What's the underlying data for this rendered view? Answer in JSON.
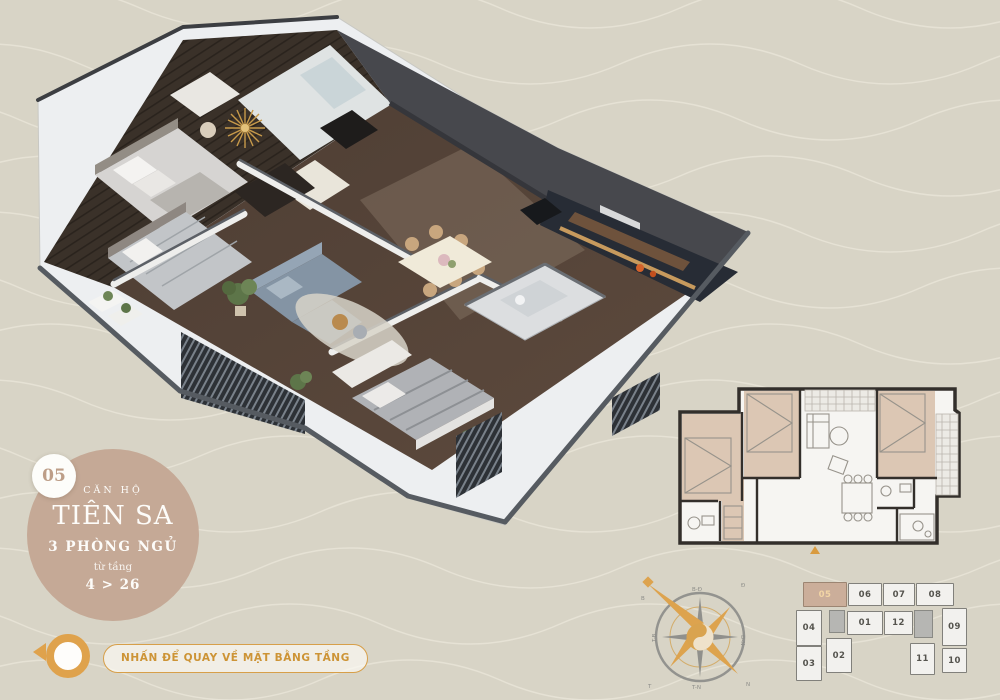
{
  "badge": {
    "unit_number": "05",
    "label_type": "CĂN HỘ",
    "name": "TIÊN SA",
    "bedrooms": "3 PHÒNG NGỦ",
    "floors_label": "từ tầng",
    "floors_range": "4 > 26",
    "circle_color": "#c5a996"
  },
  "back_button": {
    "label": "NHẤN ĐỂ QUAY VỀ MẶT BẰNG TẦNG",
    "accent_color": "#dfa24c"
  },
  "compass": {
    "corners": {
      "ne": "Đ",
      "se": "N",
      "sw": "T",
      "nw": "B"
    },
    "edges": {
      "top": "B-Đ",
      "right": "Đ-N",
      "bottom": "T-N",
      "left": "T-B"
    }
  },
  "floor_plate": {
    "highlighted_unit": "05",
    "units": [
      {
        "label": "05",
        "x": 13,
        "y": 4,
        "w": 44,
        "h": 25,
        "highlight": true
      },
      {
        "label": "06",
        "x": 58,
        "y": 5,
        "w": 34,
        "h": 23,
        "highlight": false
      },
      {
        "label": "07",
        "x": 93,
        "y": 5,
        "w": 32,
        "h": 23,
        "highlight": false
      },
      {
        "label": "08",
        "x": 126,
        "y": 5,
        "w": 38,
        "h": 23,
        "highlight": false
      },
      {
        "label": "04",
        "x": 6,
        "y": 32,
        "w": 26,
        "h": 36,
        "highlight": false
      },
      {
        "label": "01",
        "x": 57,
        "y": 33,
        "w": 36,
        "h": 24,
        "highlight": false
      },
      {
        "label": "12",
        "x": 94,
        "y": 33,
        "w": 29,
        "h": 24,
        "highlight": false
      },
      {
        "label": "09",
        "x": 152,
        "y": 30,
        "w": 25,
        "h": 38,
        "highlight": false
      },
      {
        "label": "03",
        "x": 6,
        "y": 68,
        "w": 26,
        "h": 35,
        "highlight": false
      },
      {
        "label": "02",
        "x": 36,
        "y": 60,
        "w": 26,
        "h": 35,
        "highlight": false
      },
      {
        "label": "11",
        "x": 120,
        "y": 65,
        "w": 25,
        "h": 32,
        "highlight": false
      },
      {
        "label": "10",
        "x": 152,
        "y": 70,
        "w": 25,
        "h": 25,
        "highlight": false
      }
    ],
    "cores": [
      {
        "x": 39,
        "y": 32,
        "w": 16,
        "h": 23
      },
      {
        "x": 124,
        "y": 32,
        "w": 19,
        "h": 28
      }
    ]
  }
}
